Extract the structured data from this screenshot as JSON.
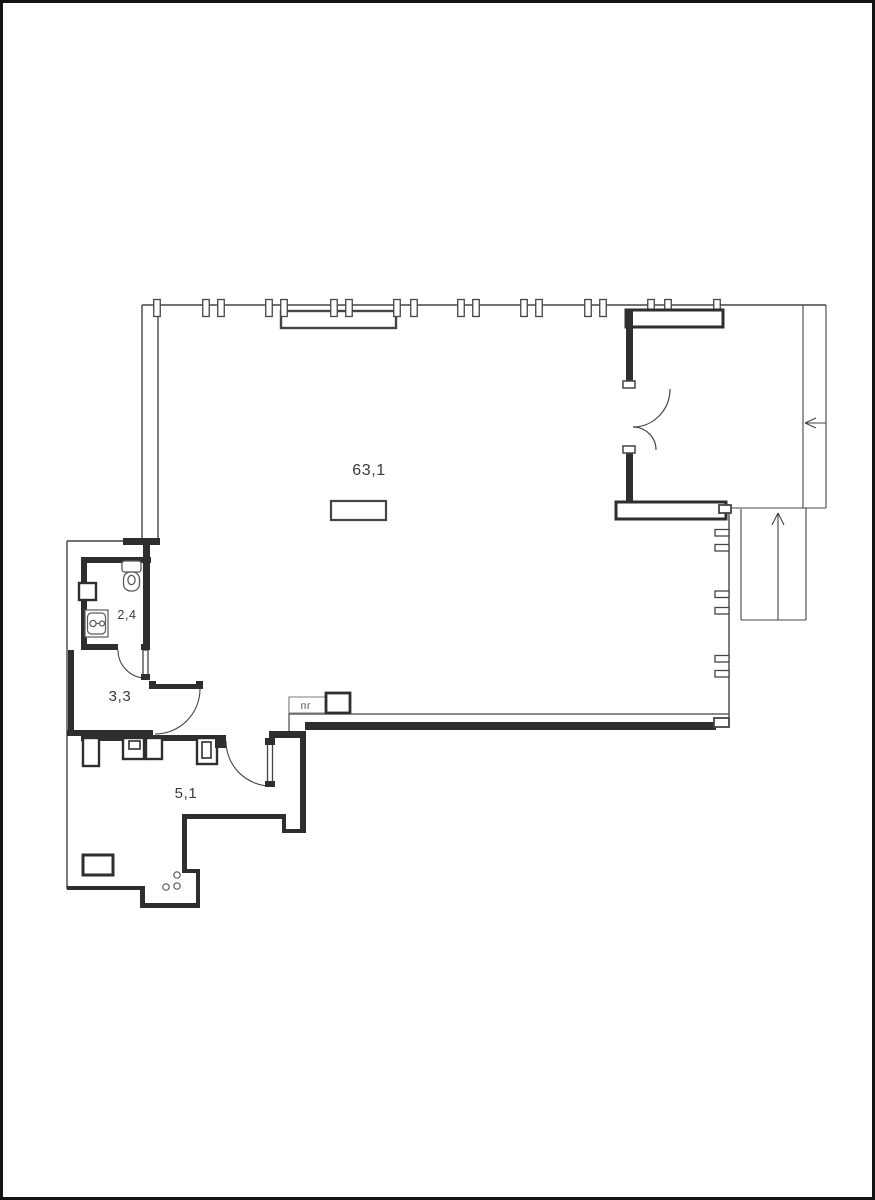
{
  "plan": {
    "title": "apartment-floor-plan",
    "rooms": [
      {
        "name": "main-room",
        "area_label": "63,1"
      },
      {
        "name": "bathroom",
        "area_label": "2,4"
      },
      {
        "name": "hall",
        "area_label": "3,3"
      },
      {
        "name": "entry-hall",
        "area_label": "5,1"
      }
    ],
    "annotations": {
      "gas_riser_label": "пг"
    },
    "colors": {
      "wall": "#2e2e2e",
      "line": "#454545",
      "background": "#ffffff",
      "frame": "#141414"
    }
  }
}
